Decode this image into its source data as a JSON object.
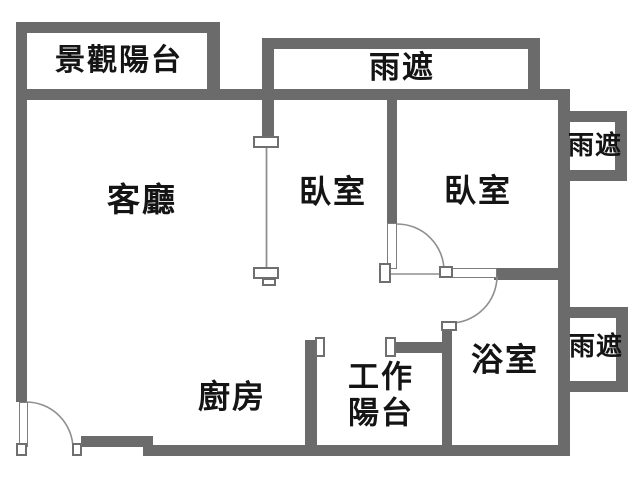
{
  "title": "apartment-floor-plan",
  "colors": {
    "wall": "#6b6b6b",
    "thin_line": "#8f8f8f",
    "text": "#141414",
    "background": "#ffffff"
  },
  "rooms": {
    "view_balcony": {
      "label": "景觀陽台"
    },
    "rain_canopy_top": {
      "label": "雨遮"
    },
    "rain_canopy_right_upper": {
      "label": "雨遮"
    },
    "rain_canopy_right_lower": {
      "label": "雨遮"
    },
    "living_room": {
      "label": "客廳"
    },
    "bedroom_1": {
      "label": "臥室"
    },
    "bedroom_2": {
      "label": "臥室"
    },
    "bathroom": {
      "label": "浴室"
    },
    "kitchen": {
      "label": "廚房"
    },
    "work_balcony": {
      "label_line1": "工作",
      "label_line2": "陽台"
    }
  }
}
